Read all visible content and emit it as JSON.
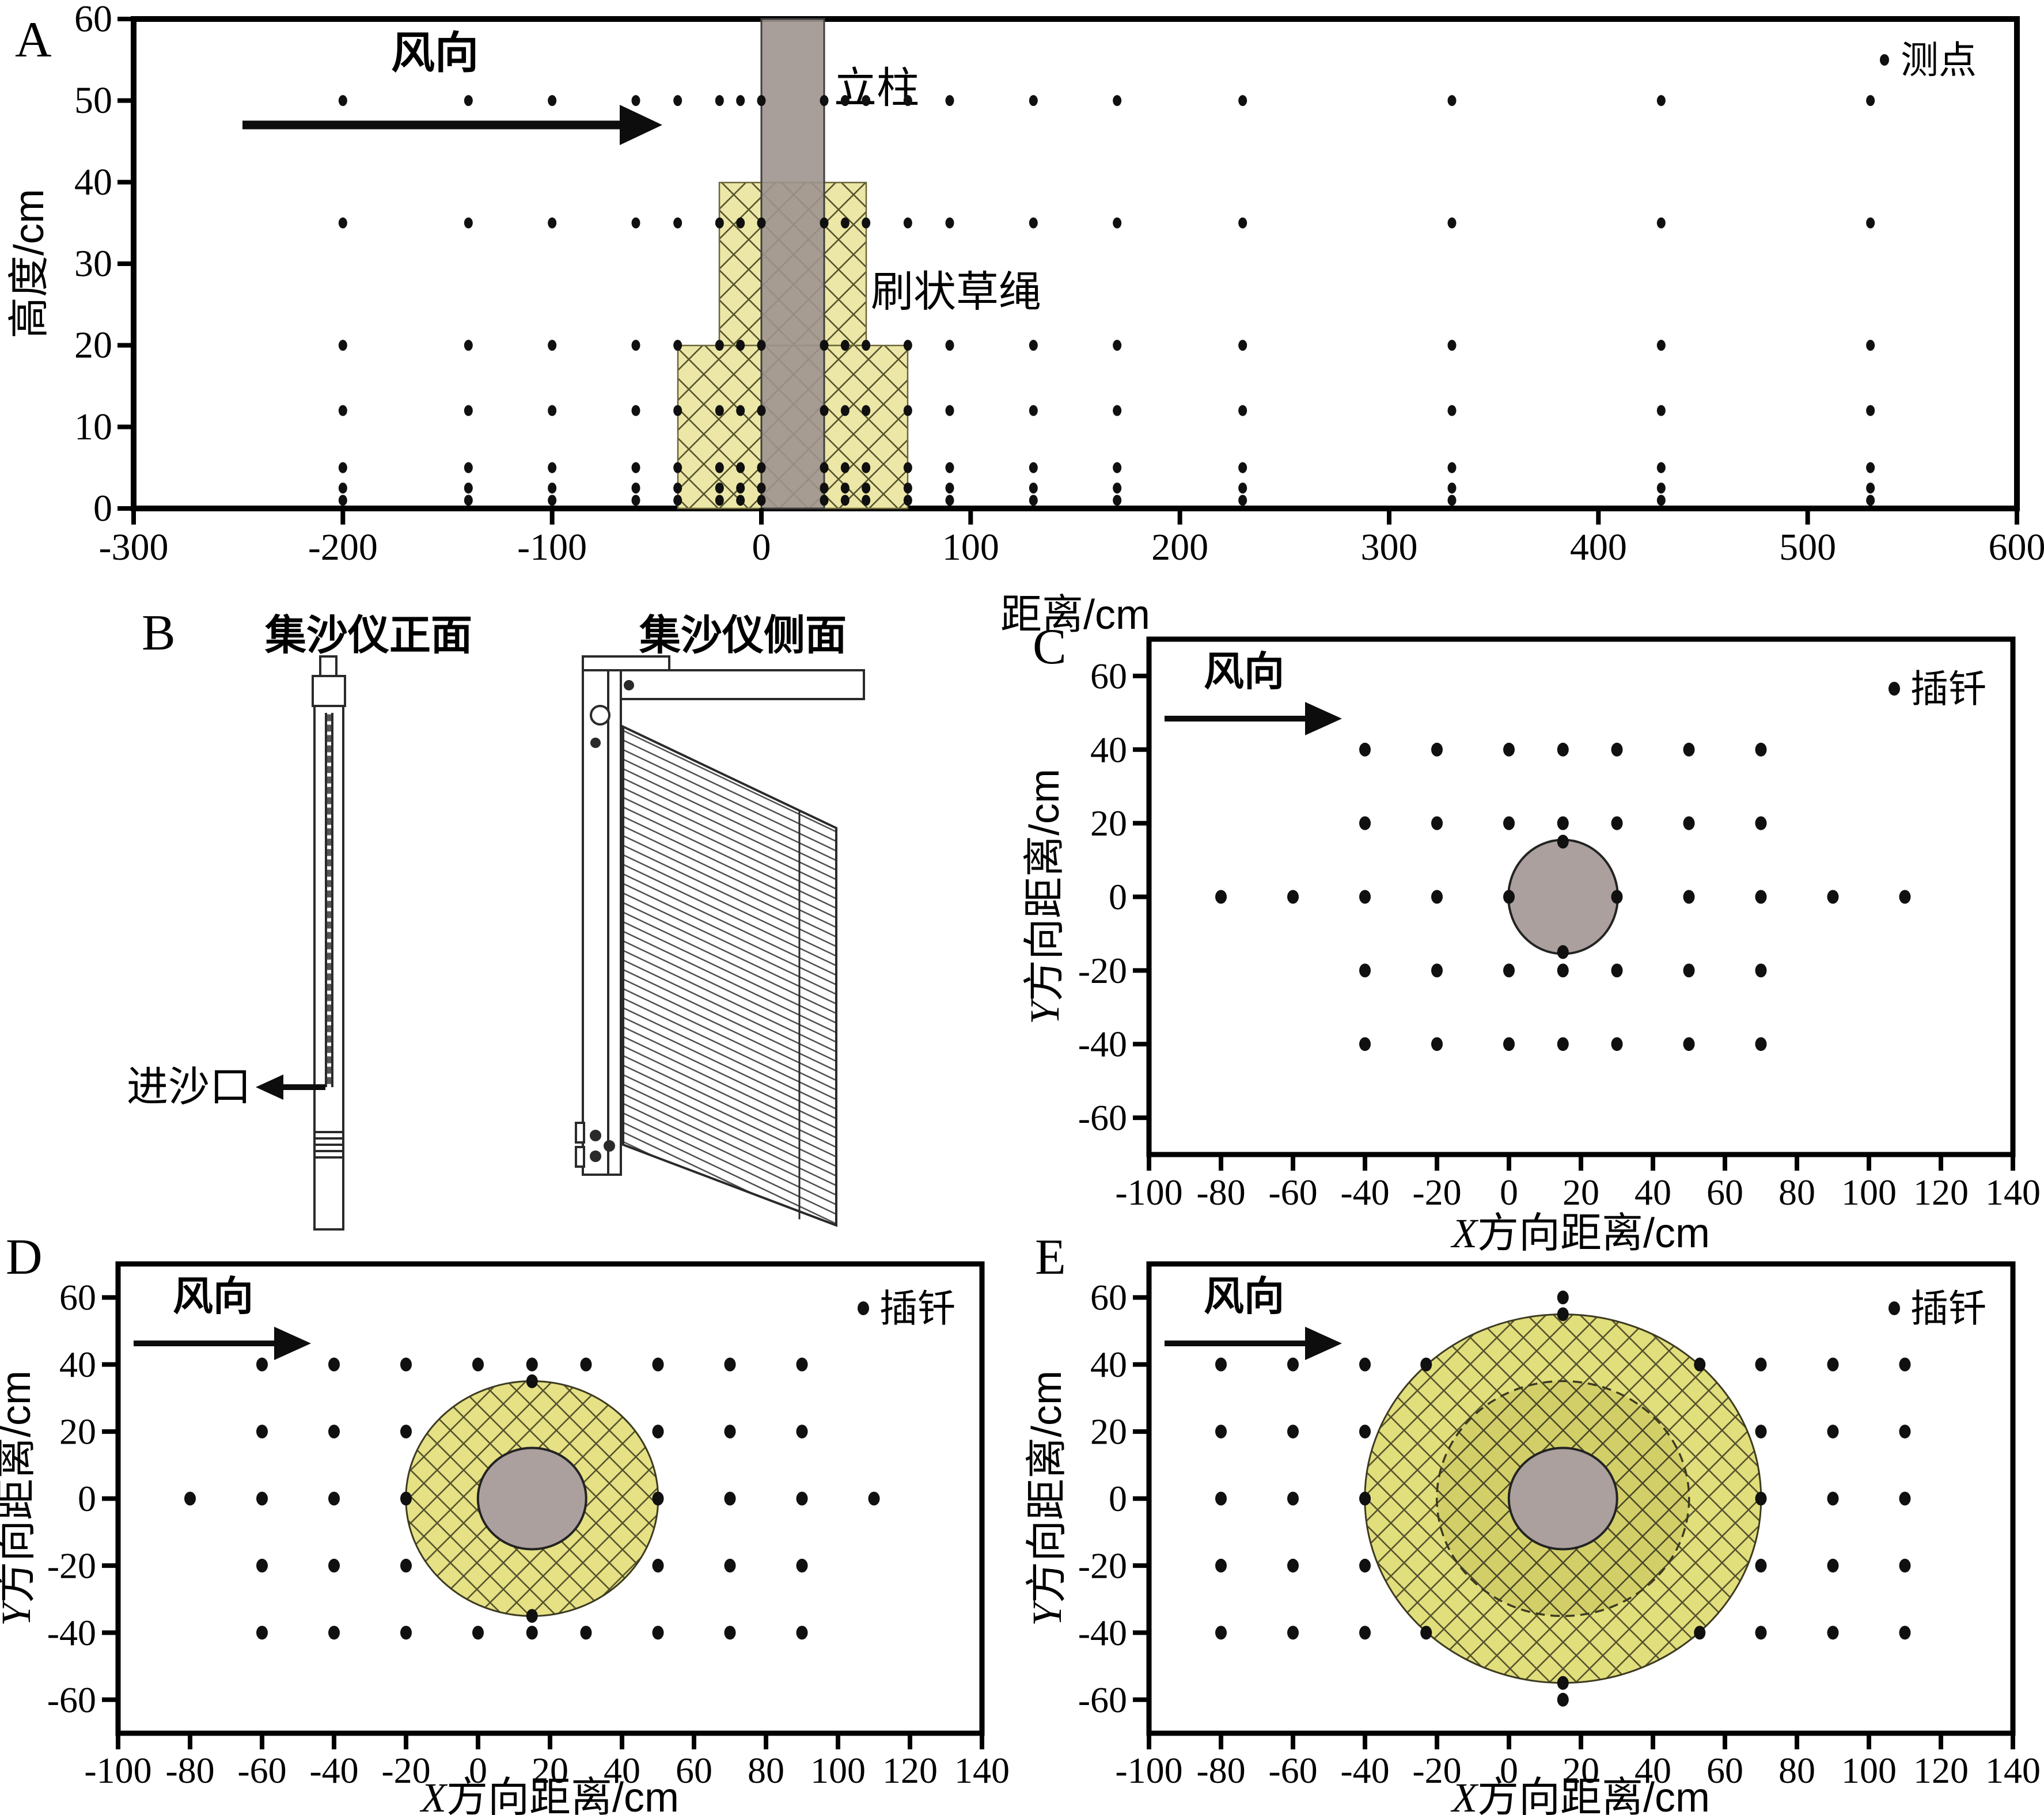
{
  "figure": {
    "panel_labels": [
      "A",
      "B",
      "C",
      "D",
      "E"
    ]
  },
  "colors": {
    "rope_hatch_fill_a": "#ece7a6",
    "rope_hatch_fill_d": "#e5e184",
    "rope_hatch_fill_e_outer": "#e1de7c",
    "rope_hatch_fill_e_inner": "#d2cf69",
    "hatch_line": "#56532e",
    "pole_gray": "#9e948f",
    "cylinder_gray": "#aba09d",
    "point_black": "#101010"
  },
  "panel_b": {
    "label": "B",
    "front_title": "集沙仪正面",
    "side_title": "集沙仪侧面",
    "inlet_label": "进沙口"
  },
  "chart_data": [
    {
      "id": "A",
      "type": "scatter",
      "wind_label": "风向",
      "legend_label": "测点",
      "pole_label": "立柱",
      "rope_label": "刷状草绳",
      "xlabel": "距离/cm",
      "ylabel": "高度/cm",
      "xlim": [
        -300,
        600
      ],
      "ylim": [
        0,
        60
      ],
      "x_ticks": [
        -300,
        -200,
        -100,
        0,
        100,
        200,
        300,
        400,
        500,
        600
      ],
      "y_ticks": [
        0,
        10,
        20,
        30,
        40,
        50,
        60
      ],
      "pole_cm": {
        "x0": 0,
        "x1": 30,
        "y0": 0,
        "y1": 60
      },
      "rope_tiers_cm": [
        {
          "x0": -20,
          "x1": 50,
          "y0": 20,
          "y1": 40
        },
        {
          "x0": -40,
          "x1": 70,
          "y0": 0,
          "y1": 20
        }
      ],
      "point_rows": [
        {
          "y": 50,
          "xs": [
            -200,
            -140,
            -100,
            -60,
            -40,
            -20,
            -10,
            0,
            30,
            40,
            50,
            70,
            90,
            130,
            170,
            230,
            330,
            430,
            530
          ]
        },
        {
          "y": 35,
          "xs": [
            -200,
            -140,
            -100,
            -60,
            -40,
            -20,
            -10,
            0,
            30,
            40,
            50,
            70,
            90,
            130,
            170,
            230,
            330,
            430,
            530
          ]
        },
        {
          "y": 20,
          "xs": [
            -200,
            -140,
            -100,
            -60,
            -40,
            -20,
            -10,
            0,
            30,
            40,
            50,
            70,
            90,
            130,
            170,
            230,
            330,
            430,
            530
          ]
        },
        {
          "y": 12,
          "xs": [
            -200,
            -140,
            -100,
            -60,
            -40,
            -20,
            -10,
            0,
            30,
            40,
            50,
            70,
            90,
            130,
            170,
            230,
            330,
            430,
            530
          ]
        },
        {
          "y": 5,
          "xs": [
            -200,
            -140,
            -100,
            -60,
            -40,
            -20,
            -10,
            0,
            30,
            40,
            50,
            70,
            90,
            130,
            170,
            230,
            330,
            430,
            530
          ]
        },
        {
          "y": 2.5,
          "xs": [
            -200,
            -140,
            -100,
            -60,
            -40,
            -20,
            -10,
            0,
            30,
            40,
            50,
            70,
            90,
            130,
            170,
            230,
            330,
            430,
            530
          ]
        },
        {
          "y": 1,
          "xs": [
            -200,
            -140,
            -100,
            -60,
            -40,
            -20,
            -10,
            0,
            30,
            40,
            50,
            70,
            90,
            130,
            170,
            230,
            330,
            430,
            530
          ]
        }
      ],
      "extra_points": []
    },
    {
      "id": "C",
      "type": "scatter",
      "wind_label": "风向",
      "legend_label": "插钎",
      "xlabel": "X方向距离/cm",
      "xlabel_prefix": "X",
      "xlabel_suffix": "方向距离/cm",
      "ylabel": "Y方向距离/cm",
      "ylabel_prefix": "Y",
      "ylabel_suffix": "方向距离/cm",
      "xlim": [
        -100,
        140
      ],
      "ylim": [
        -70,
        70
      ],
      "x_ticks": [
        -100,
        -80,
        -60,
        -40,
        -20,
        0,
        20,
        40,
        60,
        80,
        100,
        120,
        140
      ],
      "y_ticks": [
        -60,
        -40,
        -20,
        0,
        20,
        40,
        60
      ],
      "cylinder_cm": {
        "cx": 15,
        "cy": 0,
        "r": 15
      },
      "point_rows": [
        {
          "y": 40,
          "xs": [
            -40,
            -20,
            0,
            15,
            30,
            50,
            70
          ]
        },
        {
          "y": 20,
          "xs": [
            -40,
            -20,
            0,
            15,
            30,
            50,
            70
          ]
        },
        {
          "y": 0,
          "xs": [
            -80,
            -60,
            -40,
            -20,
            0,
            30,
            50,
            70,
            90,
            110
          ]
        },
        {
          "y": -20,
          "xs": [
            -40,
            -20,
            0,
            15,
            30,
            50,
            70
          ]
        },
        {
          "y": -40,
          "xs": [
            -40,
            -20,
            0,
            15,
            30,
            50,
            70
          ]
        }
      ],
      "extra_points": [
        [
          15,
          15
        ],
        [
          15,
          -15
        ]
      ]
    },
    {
      "id": "D",
      "type": "scatter",
      "wind_label": "风向",
      "legend_label": "插钎",
      "xlabel": "X方向距离/cm",
      "xlabel_prefix": "X",
      "xlabel_suffix": "方向距离/cm",
      "ylabel": "Y方向距离/cm",
      "ylabel_prefix": "Y",
      "ylabel_suffix": "方向距离/cm",
      "xlim": [
        -100,
        140
      ],
      "ylim": [
        -70,
        70
      ],
      "x_ticks": [
        -100,
        -80,
        -60,
        -40,
        -20,
        0,
        20,
        40,
        60,
        80,
        100,
        120,
        140
      ],
      "y_ticks": [
        -60,
        -40,
        -20,
        0,
        20,
        40,
        60
      ],
      "cylinder_cm": {
        "cx": 15,
        "cy": 0,
        "r": 15
      },
      "rope_ring_cm": {
        "cx": 15,
        "cy": 0,
        "r": 35
      },
      "point_rows": [
        {
          "y": 40,
          "xs": [
            -60,
            -40,
            -20,
            0,
            15,
            30,
            50,
            70,
            90
          ]
        },
        {
          "y": 20,
          "xs": [
            -60,
            -40,
            -20,
            50,
            70,
            90
          ]
        },
        {
          "y": 0,
          "xs": [
            -80,
            -60,
            -40,
            -20,
            50,
            70,
            90,
            110
          ]
        },
        {
          "y": -20,
          "xs": [
            -60,
            -40,
            -20,
            50,
            70,
            90
          ]
        },
        {
          "y": -40,
          "xs": [
            -60,
            -40,
            -20,
            0,
            15,
            30,
            50,
            70,
            90
          ]
        }
      ],
      "extra_points": [
        [
          15,
          35
        ],
        [
          15,
          -35
        ]
      ]
    },
    {
      "id": "E",
      "type": "scatter",
      "wind_label": "风向",
      "legend_label": "插钎",
      "xlabel": "X方向距离/cm",
      "xlabel_prefix": "X",
      "xlabel_suffix": "方向距离/cm",
      "ylabel": "Y方向距离/cm",
      "ylabel_prefix": "Y",
      "ylabel_suffix": "方向距离/cm",
      "xlim": [
        -100,
        140
      ],
      "ylim": [
        -70,
        70
      ],
      "x_ticks": [
        -100,
        -80,
        -60,
        -40,
        -20,
        0,
        20,
        40,
        60,
        80,
        100,
        120,
        140
      ],
      "y_ticks": [
        -60,
        -40,
        -20,
        0,
        20,
        40,
        60
      ],
      "cylinder_cm": {
        "cx": 15,
        "cy": 0,
        "r": 15
      },
      "rope_outer_ring_cm": {
        "cx": 15,
        "cy": 0,
        "r": 55
      },
      "rope_dashed_ring_cm": {
        "cx": 15,
        "cy": 0,
        "r": 35
      },
      "point_rows": [
        {
          "y": 40,
          "xs": [
            -80,
            -60,
            -40,
            -23,
            53,
            70,
            90,
            110
          ]
        },
        {
          "y": 20,
          "xs": [
            -80,
            -60,
            -40,
            70,
            90,
            110
          ]
        },
        {
          "y": 0,
          "xs": [
            -80,
            -60,
            -40,
            70,
            90,
            110
          ]
        },
        {
          "y": -20,
          "xs": [
            -80,
            -60,
            -40,
            70,
            90,
            110
          ]
        },
        {
          "y": -40,
          "xs": [
            -80,
            -60,
            -40,
            -23,
            53,
            70,
            90,
            110
          ]
        }
      ],
      "extra_points": [
        [
          15,
          60
        ],
        [
          15,
          55
        ],
        [
          15,
          -55
        ],
        [
          15,
          -60
        ]
      ]
    }
  ]
}
